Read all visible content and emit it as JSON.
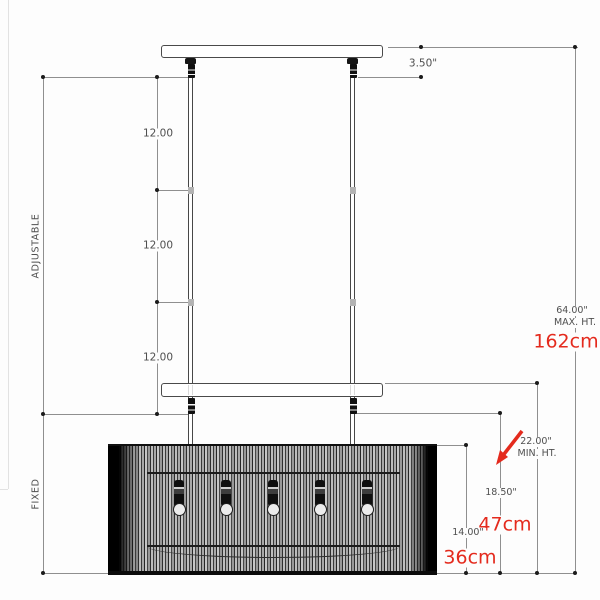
{
  "drawing": {
    "labels": {
      "adjustable": "ADJUSTABLE",
      "fixed": "FIXED"
    },
    "dims": {
      "canopy_offset_in": "3.50\"",
      "rod_segments": [
        "12.00",
        "12.00",
        "12.00"
      ],
      "shade_height_in": "14.00\"",
      "min_drop_in": "18.50\"",
      "min_height_in": "22.00\"",
      "min_height_caption": "MIN. HT.",
      "max_height_in": "64.00\"",
      "max_height_caption": "MAX. HT.",
      "max_height_cm": "162cm",
      "min_drop_cm": "47cm",
      "shade_height_cm": "36cm"
    },
    "colors": {
      "accent_red": "#e42a1d",
      "line_dark": "#4a4a4a",
      "line_dim": "#8f8f8f",
      "text_gray": "#4f4f4f"
    }
  }
}
